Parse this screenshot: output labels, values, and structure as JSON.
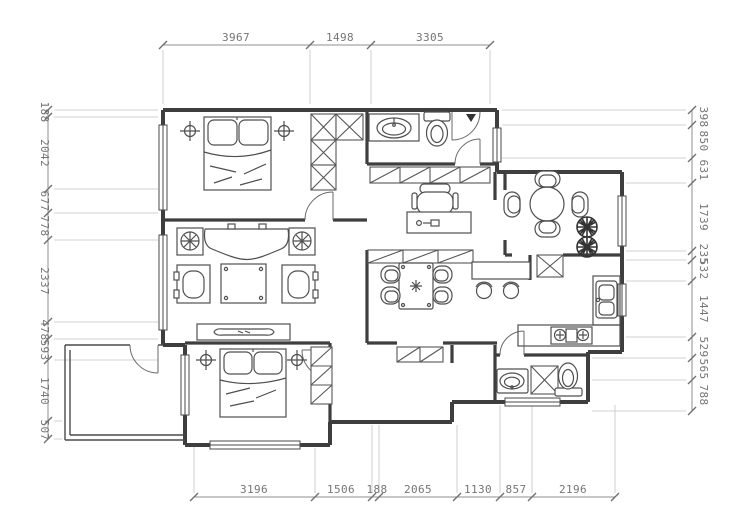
{
  "drawing": {
    "type": "apartment-floor-plan",
    "background": "#ffffff",
    "wall_color": "#3e3e3e",
    "furniture_color": "#4f4f4f",
    "dimension_text_color": "#757575"
  },
  "dimensions": {
    "top": [
      "3967",
      "1498",
      "3305"
    ],
    "bottom": [
      "3196",
      "1506",
      "188",
      "2065",
      "1130",
      "857",
      "2196"
    ],
    "left": [
      "188",
      "2042",
      "677",
      "778",
      "2337",
      "478",
      "593",
      "1740",
      "507"
    ],
    "right": [
      "398",
      "850",
      "631",
      "1739",
      "235",
      "532",
      "1447",
      "529",
      "565",
      "788"
    ]
  }
}
